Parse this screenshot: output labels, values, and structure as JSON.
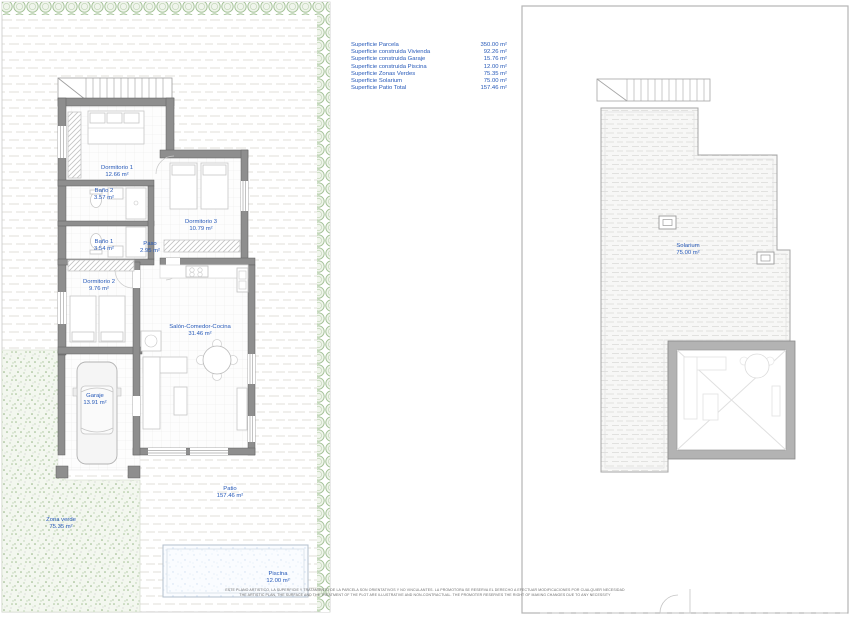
{
  "colors": {
    "label_blue": "#2558b8",
    "hedge_green": "#9fbf92",
    "lawn_green": "#a7c297",
    "wall_gray": "#8e8e8e",
    "paving_line": "#e8e6e2",
    "pool_blue": "#d7e4f3"
  },
  "legend": {
    "rows": [
      {
        "label": "Superficie Parcela",
        "value": "350.00 m²"
      },
      {
        "label": "Superficie construida Vivienda",
        "value": "92.26 m²"
      },
      {
        "label": "Superficie construida Garaje",
        "value": "15.76 m²"
      },
      {
        "label": "Superficie construida Piscina",
        "value": "12.00 m²"
      },
      {
        "label": "Superficie Zonas Verdes",
        "value": "75.35 m²"
      },
      {
        "label": "Superficie Solarium",
        "value": "75.00 m²"
      },
      {
        "label": "Superficie Patio Total",
        "value": "157.46 m²"
      }
    ]
  },
  "ground_floor": {
    "rooms": [
      {
        "name": "Dormitorio 1",
        "area": "12.66 m²"
      },
      {
        "name": "Baño 2",
        "area": "3.57 m²"
      },
      {
        "name": "Dormitorio 3",
        "area": "10.79 m²"
      },
      {
        "name": "Baño 1",
        "area": "3.54 m²"
      },
      {
        "name": "Paso",
        "area": "2.95 m²"
      },
      {
        "name": "Dormitorio 2",
        "area": "9.76 m²"
      },
      {
        "name": "Salón-Comedor-Cocina",
        "area": "31.46 m²"
      },
      {
        "name": "Garaje",
        "area": "13.91 m²"
      },
      {
        "name": "Zona verde",
        "area": "75.35 m²"
      },
      {
        "name": "Patio",
        "area": "157.46 m²"
      },
      {
        "name": "Piscina",
        "area": "12.00 m²"
      }
    ]
  },
  "roof_plan": {
    "rooms": [
      {
        "name": "Solarium",
        "area": "75.00 m²"
      }
    ]
  },
  "disclaimer": {
    "line1": "ESTE PLANO ARTISTICO, LA SUPERFICIE Y TRATAMIENTO DE LA PARCELA SON ORIENTATIVOS Y NO VINCULANTES. LA PROMOTORA SE RESERVA EL DERECHO A EFECTUAR MODIFICACIONES POR CUALQUIER NECESIDAD",
    "line2": "THE ARTISTIC PLAN, THE SURFACE AND THE TREATMENT OF THE PLOT ARE ILLUSTRATIVE AND NON-CONTRACTUAL. THE PROMOTER RESERVES THE RIGHT OF MAKING CHANGES DUE TO ANY NECESSITY"
  }
}
